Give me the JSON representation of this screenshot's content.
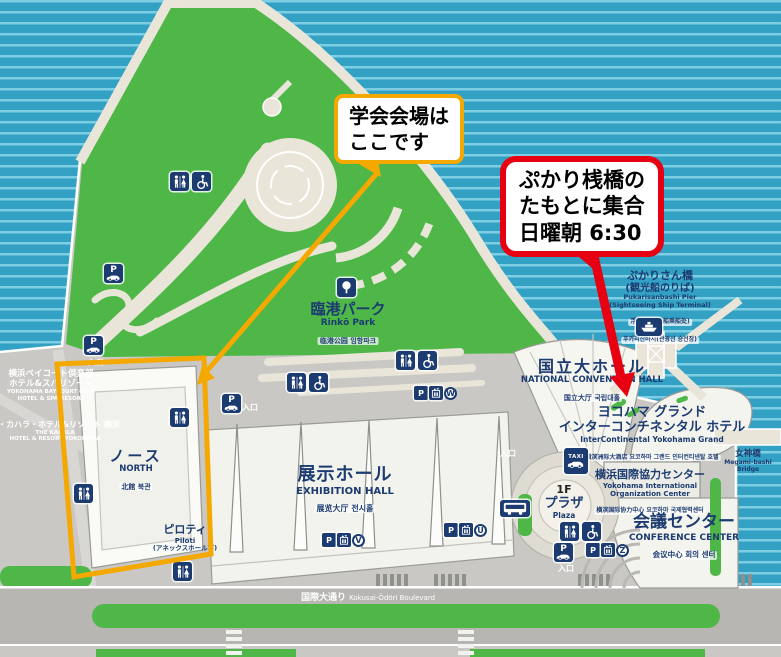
{
  "colors": {
    "water": "#33a1c4",
    "water_stripe": "#82d0e5",
    "park_green": "#4eb748",
    "land_gray": "#c9c8c4",
    "navy": "#1c3b70",
    "accent_orange": "#f5a900",
    "accent_red": "#e60012"
  },
  "callouts": {
    "venue": {
      "line1": "学会会場は",
      "line2": "ここです"
    },
    "meeting": {
      "line1": "ぷかり桟橋の",
      "line2": "たもとに集合",
      "line3": "日曜朝 6:30"
    }
  },
  "labels": {
    "rinko": {
      "ja": "臨港パーク",
      "en": "Rinkō Park",
      "cjk": "临港公园 임항파크"
    },
    "national": {
      "ja": "国立大ホール",
      "en": "NATIONAL CONVENTION HALL",
      "cjk": "国立大厅 국립대홀"
    },
    "pukari": {
      "ja1": "ぷかりさん橋",
      "ja2": "(観光船のりば)",
      "en1": "Pukarisanbashi Pier",
      "en2": "(Sightseeing Ship Terminal)",
      "cjk1": "浮码头(观光船乘船处)",
      "cjk2": "푸카리산바시(관광선 승선장)"
    },
    "hotel": {
      "ja1": "ヨコハマ グランド",
      "ja2": "インターコンチネンタル ホテル",
      "en": "InterContinental Yokohama Grand",
      "cjk": "横滨洲际大酒店 요코하마 그랜드 인터컨티넨탈 호텔"
    },
    "org": {
      "ja": "横浜国際協力センター",
      "en1": "Yokohama International",
      "en2": "Organization Center",
      "cjk": "横滨国际协力中心 요코하마 국제협력센터"
    },
    "conference": {
      "ja": "会議センター",
      "en": "CONFERENCE CENTER",
      "cjk": "会议中心 회의 센터"
    },
    "exhibition": {
      "ja": "展示ホール",
      "en": "EXHIBITION HALL",
      "cjk": "展览大厅 전시홀"
    },
    "north": {
      "ja": "ノース",
      "en": "NORTH",
      "cjk": "北館 북관"
    },
    "piloti": {
      "ja": "ピロティ",
      "en": "Piloti",
      "note": "(アネックスホール下)"
    },
    "plaza": {
      "floor": "1F",
      "ja": "プラザ",
      "en": "Plaza"
    },
    "megami": {
      "ja": "女神橋",
      "en1": "Megami-bashi",
      "en2": "Bridge"
    },
    "boulevard": {
      "ja": "国際大通り",
      "en": "Kokusai-Ōdōri Boulevard"
    },
    "baycourt": {
      "ja1": "横浜ベイコート倶楽部",
      "ja2": "ホテル&スパリゾート",
      "en1": "YOKOHAMA BAYCOURT CLUB",
      "en2": "HOTEL & SPA RESORT"
    },
    "kahala": {
      "ja": "ザ・カハラ・ホテル&リゾート 横浜",
      "en1": "THE KAHALA",
      "en2": "HOTEL & RESORT YOKOHAMA"
    },
    "entrance": "入口"
  },
  "icons": {
    "parking": "P",
    "taxi": "TAXI",
    "badge_w": "W",
    "badge_v": "V",
    "badge_u": "U",
    "badge_z": "Z"
  }
}
